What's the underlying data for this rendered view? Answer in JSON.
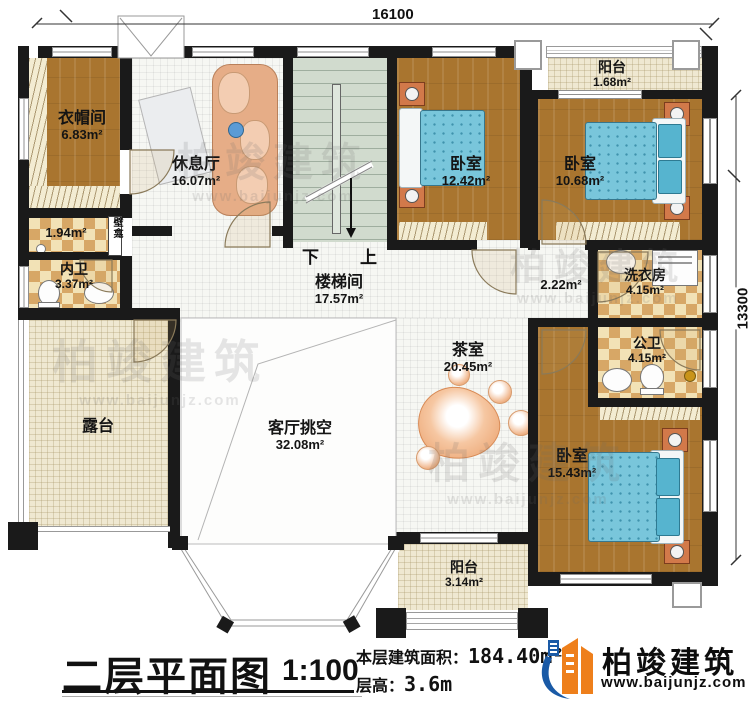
{
  "dimensions": {
    "top": "16100",
    "right": "13300"
  },
  "rooms": {
    "cloakroom": {
      "name": "衣帽间",
      "area": "6.83m²"
    },
    "lounge": {
      "name": "休息厅",
      "area": "16.07m²"
    },
    "bedroom1": {
      "name": "卧室",
      "area": "12.42m²"
    },
    "balcony_top": {
      "name": "阳台",
      "area": "1.68m²"
    },
    "bedroom2": {
      "name": "卧室",
      "area": "10.68m²"
    },
    "closet": {
      "area": "1.94m²"
    },
    "niche": {
      "name": "壁龛"
    },
    "inner_bath": {
      "name": "内卫",
      "area": "3.37m²"
    },
    "stairwell": {
      "name": "楼梯间",
      "area": "17.57m²"
    },
    "hallway": {
      "area": "2.22m²"
    },
    "laundry": {
      "name": "洗衣房",
      "area": "4.15m²"
    },
    "public_bath": {
      "name": "公卫",
      "area": "4.15m²"
    },
    "tea_room": {
      "name": "茶室",
      "area": "20.45m²"
    },
    "terrace": {
      "name": "露台"
    },
    "living_void": {
      "name": "客厅挑空",
      "area": "32.08m²"
    },
    "bedroom3": {
      "name": "卧室",
      "area": "15.43m²"
    },
    "balcony_bottom": {
      "name": "阳台",
      "area": "3.14m²"
    }
  },
  "stairs": {
    "down": "下",
    "up": "上"
  },
  "title_block": {
    "title": "二层平面图",
    "scale": "1:100",
    "area_label": "本层建筑面积：",
    "area_value": "184.40m²",
    "height_label": "层高：",
    "height_value": "3.6m"
  },
  "brand": {
    "name": "柏竣建筑",
    "website": "www.baijunjz.com"
  },
  "watermark": {
    "name": "柏竣建筑",
    "website": "www.baijunjz.com"
  },
  "colors": {
    "wall": "#1a1a1a",
    "wood": "#a9752f",
    "checker_tile": "#d7a766",
    "bed": "#79c6db",
    "brand_blue": "#1a5aa6",
    "brand_orange": "#ee7f1b"
  }
}
